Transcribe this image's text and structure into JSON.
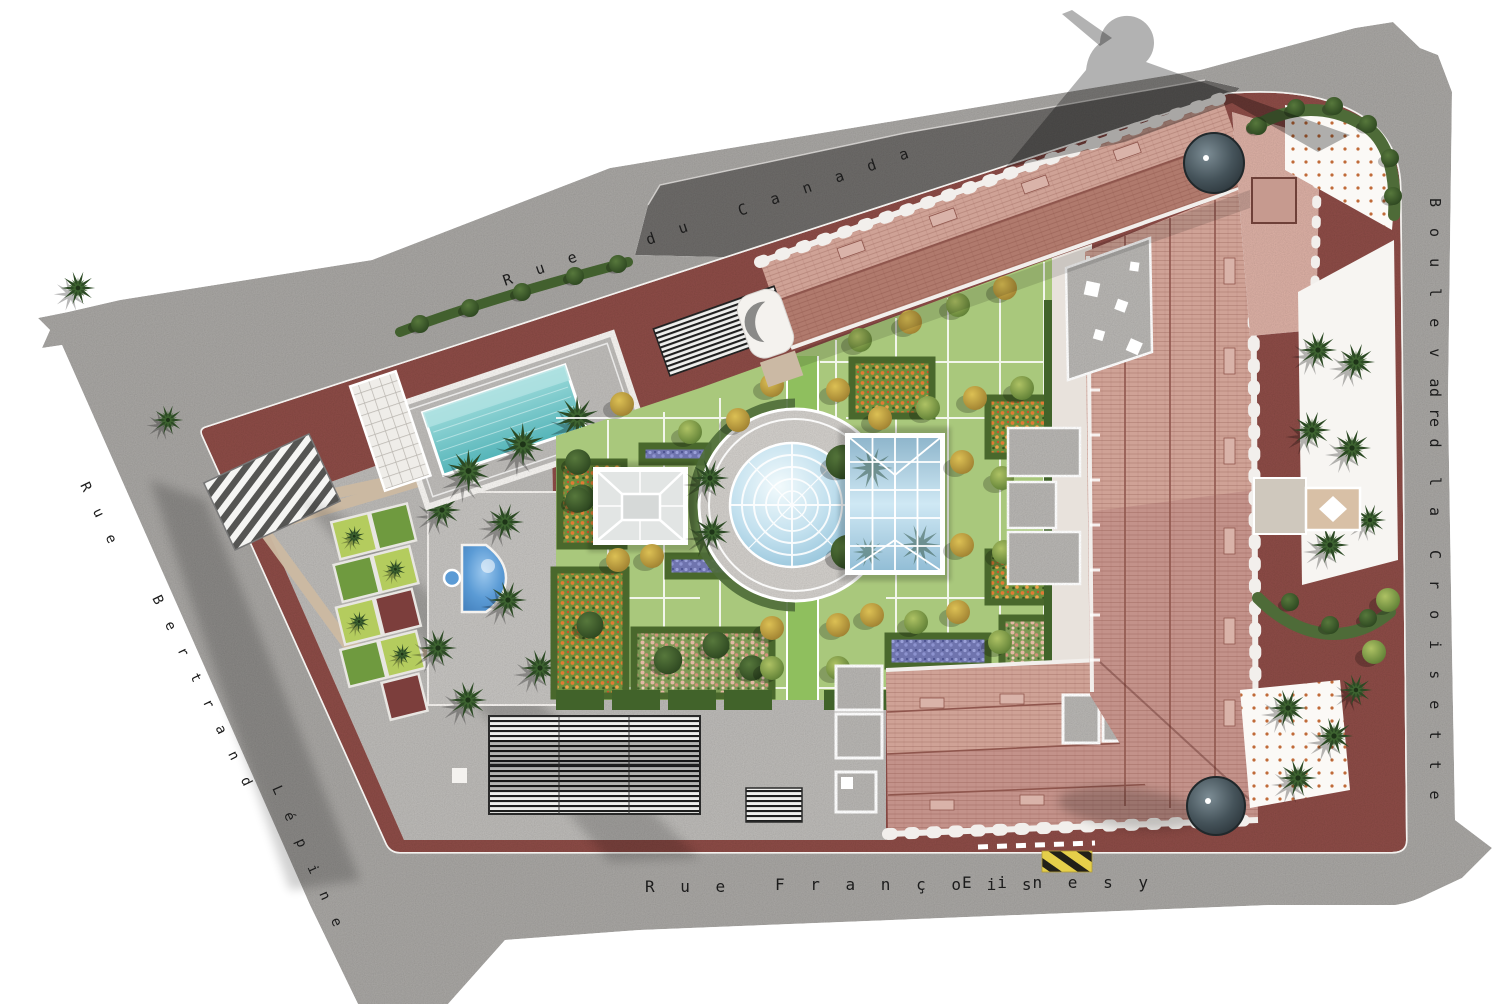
{
  "title": "Architectural landscape site plan",
  "streets": {
    "canada": {
      "name": "Rue du Canada",
      "words": [
        "R u e",
        "d u",
        "C a n a d a"
      ]
    },
    "croisette": {
      "name": "Boulevard de la Croisette",
      "words": [
        "B o u l e v a r d",
        "d e",
        "l a",
        "C r o i s e t t e"
      ]
    },
    "einesy": {
      "name": "Rue François Einesy",
      "words": [
        "R u e",
        "F r a n ç o i s",
        "E i n e s y"
      ]
    },
    "lepine": {
      "name": "Rue Bertrand Lépine",
      "words": [
        "R u e",
        "B e r t r a n d",
        "L é p i n e"
      ]
    }
  },
  "colors": {
    "street_sidewalk": "#a5a3a0",
    "street_road": "#6b6967",
    "perimeter_paving": "#8a4a45",
    "building_roof_light": "#cfa296",
    "building_roof_dark": "#b07a6d",
    "white_trim": "#f2efec",
    "turret_slate": "#3a464b",
    "plaza": "#b9b7b4",
    "lawn": "#a9c87c",
    "lawn_bright": "#8fbf5e",
    "hedge": "#41632a",
    "pool_water": "#6fc5c8",
    "fountain_water": "#4e92d2",
    "glass_blue": "#aed3e4",
    "path_beige": "#cdbaa2",
    "flowers_orange": "#e07b35",
    "flowers_purple": "#8083bd",
    "flowers_pink": "#e4b8a4",
    "hazard_yellow": "#e6cf4a"
  }
}
